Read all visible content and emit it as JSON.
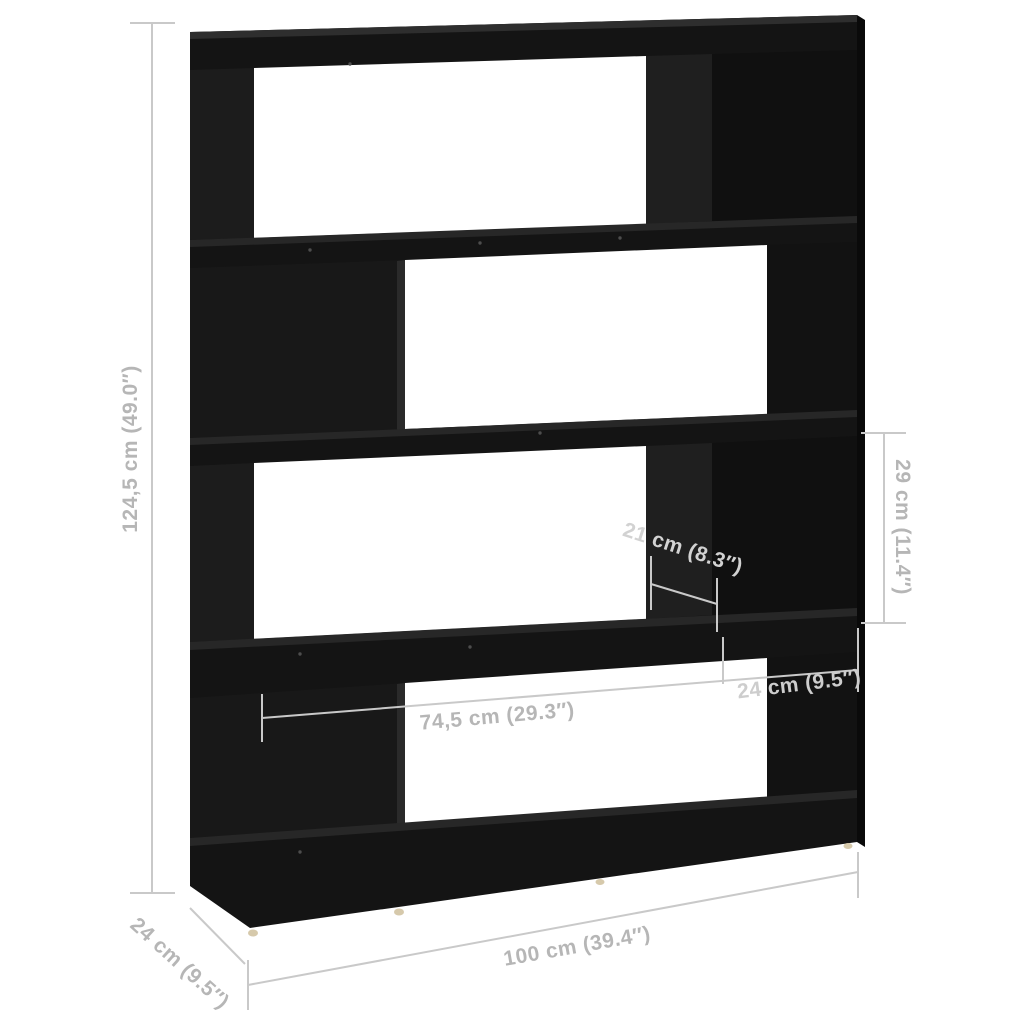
{
  "illustration": {
    "type": "product-dimension-diagram",
    "subject": "4-tier book cabinet room divider, black",
    "background_color": "#ffffff",
    "furniture_color": "#141414",
    "dimension_line_color": "#c9c9c9",
    "dimension_text_color": "#b6b6b6",
    "feet_color": "#d6c9ab",
    "dimensions": {
      "total_height": "124,5 cm (49.0″)",
      "compartment_height": "29 cm (11.4″)",
      "inner_depth": "21 cm (8.3″)",
      "opening_width": "74,5 cm (29.3″)",
      "block_width": "24 cm (9.5″)",
      "total_width": "100 cm (39.4″)",
      "total_depth": "24 cm (9.5″)"
    }
  }
}
